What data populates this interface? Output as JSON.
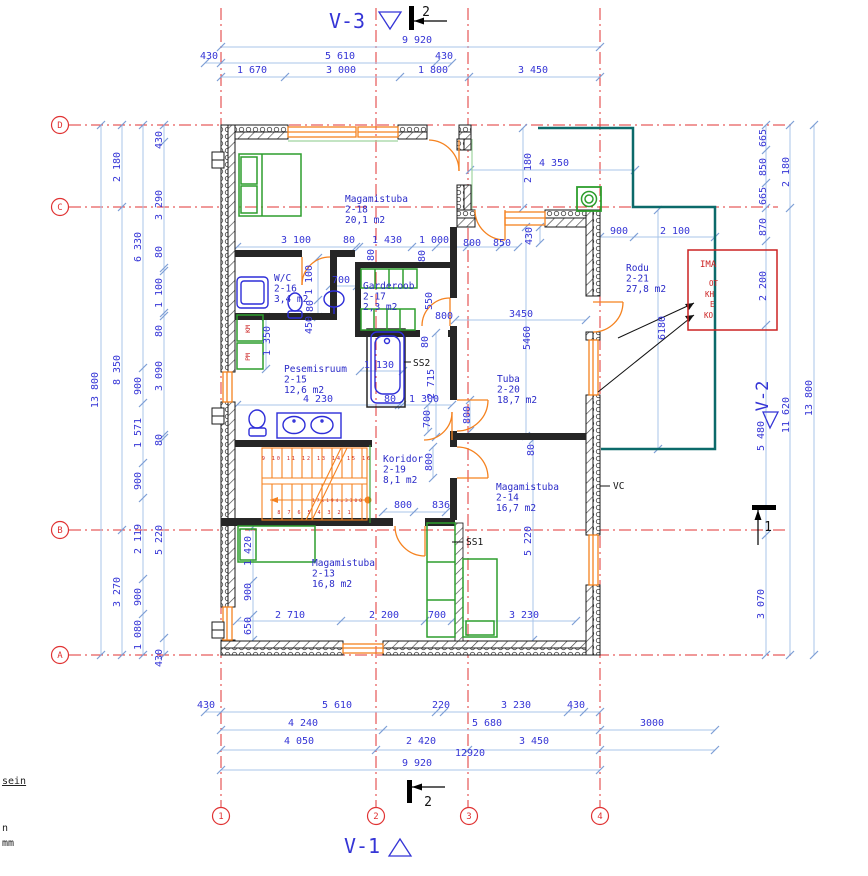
{
  "colors": {
    "dim_text": "#3535d6",
    "room_text": "#2a2ac8",
    "grid_red": "#e03333",
    "wall": "#1a1a1a",
    "window_orange": "#f5821f",
    "furniture_green": "#2d9e2d",
    "fixture_blue": "#2d2dd8",
    "terrace_teal": "#0c6a6a",
    "note_red": "#cc2222",
    "dim_line": "#a9c4ea"
  },
  "grid": {
    "rows": [
      {
        "label": "D",
        "y": 125
      },
      {
        "label": "C",
        "y": 207
      },
      {
        "label": "B",
        "y": 530
      },
      {
        "label": "A",
        "y": 655
      }
    ],
    "cols": [
      {
        "label": "1",
        "x": 221
      },
      {
        "label": "2",
        "x": 376
      },
      {
        "label": "3",
        "x": 469
      },
      {
        "label": "4",
        "x": 600
      }
    ]
  },
  "rooms": [
    {
      "name": "Magamistuba",
      "number": "2-18",
      "area": "20,1 m2",
      "x": 345,
      "y": 202
    },
    {
      "name": "W/C",
      "number": "2-16",
      "area": "3,4 m2",
      "x": 274,
      "y": 281
    },
    {
      "name": "Garderoob",
      "number": "2-17",
      "area": "2,3 m2",
      "x": 363,
      "y": 289
    },
    {
      "name": "Pesemisruum",
      "number": "2-15",
      "area": "12,6 m2",
      "x": 284,
      "y": 372
    },
    {
      "name": "Koridor",
      "number": "2-19",
      "area": "8,1 m2",
      "x": 383,
      "y": 462
    },
    {
      "name": "Tuba",
      "number": "2-20",
      "area": "18,7 m2",
      "x": 497,
      "y": 382
    },
    {
      "name": "Magamistuba",
      "number": "2-14",
      "area": "16,7 m2",
      "x": 496,
      "y": 490
    },
    {
      "name": "Magamistuba",
      "number": "2-13",
      "area": "16,8 m2",
      "x": 312,
      "y": 566
    },
    {
      "name": "Rodu",
      "number": "2-21",
      "area": "27,8 m2",
      "x": 626,
      "y": 271
    }
  ],
  "texts": {
    "view_labels": [
      {
        "t": "V-3",
        "x": 347,
        "y": 28,
        "s": 20
      },
      {
        "t": "V-1",
        "x": 362,
        "y": 853,
        "s": 20
      },
      {
        "t": "V-2",
        "x": 768,
        "y": 396,
        "s": 17,
        "r": -90
      }
    ],
    "section_labels": [
      {
        "t": "2",
        "x": 426,
        "y": 16
      },
      {
        "t": "2",
        "x": 428,
        "y": 806
      },
      {
        "t": "1",
        "x": 768,
        "y": 531
      }
    ],
    "dims": [
      {
        "t": "9 920",
        "x": 417,
        "y": 43
      },
      {
        "t": "430",
        "x": 209,
        "y": 59
      },
      {
        "t": "5 610",
        "x": 340,
        "y": 59
      },
      {
        "t": "430",
        "x": 444,
        "y": 59
      },
      {
        "t": "1 670",
        "x": 252,
        "y": 73
      },
      {
        "t": "3 000",
        "x": 341,
        "y": 73
      },
      {
        "t": "1 800",
        "x": 433,
        "y": 73
      },
      {
        "t": "3 450",
        "x": 533,
        "y": 73
      },
      {
        "t": "13 800",
        "x": 98,
        "y": 390,
        "r": -90
      },
      {
        "t": "2 180",
        "x": 120,
        "y": 167,
        "r": -90
      },
      {
        "t": "8 350",
        "x": 120,
        "y": 370,
        "r": -90
      },
      {
        "t": "3 270",
        "x": 120,
        "y": 592,
        "r": -90
      },
      {
        "t": "6 330",
        "x": 141,
        "y": 247,
        "r": -90
      },
      {
        "t": "900",
        "x": 141,
        "y": 386,
        "r": -90
      },
      {
        "t": "1 571",
        "x": 141,
        "y": 433,
        "r": -90
      },
      {
        "t": "900",
        "x": 141,
        "y": 481,
        "r": -90
      },
      {
        "t": "2 119",
        "x": 141,
        "y": 539,
        "r": -90
      },
      {
        "t": "900",
        "x": 141,
        "y": 597,
        "r": -90
      },
      {
        "t": "1 080",
        "x": 141,
        "y": 635,
        "r": -90
      },
      {
        "t": "430",
        "x": 162,
        "y": 140,
        "r": -90
      },
      {
        "t": "3 290",
        "x": 162,
        "y": 205,
        "r": -90
      },
      {
        "t": "80",
        "x": 162,
        "y": 252,
        "r": -90
      },
      {
        "t": "1 100",
        "x": 162,
        "y": 293,
        "r": -90
      },
      {
        "t": "80",
        "x": 162,
        "y": 331,
        "r": -90
      },
      {
        "t": "3 090",
        "x": 162,
        "y": 376,
        "r": -90
      },
      {
        "t": "80",
        "x": 162,
        "y": 440,
        "r": -90
      },
      {
        "t": "5 220",
        "x": 162,
        "y": 540,
        "r": -90
      },
      {
        "t": "430",
        "x": 162,
        "y": 658,
        "r": -90
      },
      {
        "t": "665",
        "x": 766,
        "y": 138,
        "r": -90
      },
      {
        "t": "850",
        "x": 766,
        "y": 167,
        "r": -90
      },
      {
        "t": "665",
        "x": 766,
        "y": 196,
        "r": -90
      },
      {
        "t": "870",
        "x": 766,
        "y": 227,
        "r": -90
      },
      {
        "t": "2 200",
        "x": 766,
        "y": 286,
        "r": -90
      },
      {
        "t": "5 480",
        "x": 764,
        "y": 436,
        "r": -90
      },
      {
        "t": "3 070",
        "x": 764,
        "y": 604,
        "r": -90
      },
      {
        "t": "2 180",
        "x": 789,
        "y": 172,
        "r": -90
      },
      {
        "t": "11 620",
        "x": 789,
        "y": 415,
        "r": -90
      },
      {
        "t": "13 800",
        "x": 812,
        "y": 398,
        "r": -90
      },
      {
        "t": "430",
        "x": 206,
        "y": 708
      },
      {
        "t": "5 610",
        "x": 337,
        "y": 708
      },
      {
        "t": "220",
        "x": 441,
        "y": 708
      },
      {
        "t": "3 230",
        "x": 516,
        "y": 708
      },
      {
        "t": "430",
        "x": 576,
        "y": 708
      },
      {
        "t": "4 240",
        "x": 303,
        "y": 726
      },
      {
        "t": "5 680",
        "x": 487,
        "y": 726
      },
      {
        "t": "3000",
        "x": 652,
        "y": 726
      },
      {
        "t": "4 050",
        "x": 299,
        "y": 744
      },
      {
        "t": "2 420",
        "x": 421,
        "y": 744
      },
      {
        "t": "3 450",
        "x": 534,
        "y": 744
      },
      {
        "t": "12920",
        "x": 470,
        "y": 756
      },
      {
        "t": "9 920",
        "x": 417,
        "y": 766
      },
      {
        "t": "3 100",
        "x": 296,
        "y": 243
      },
      {
        "t": "80",
        "x": 349,
        "y": 243
      },
      {
        "t": "1 430",
        "x": 387,
        "y": 243
      },
      {
        "t": "1 000",
        "x": 434,
        "y": 243
      },
      {
        "t": "800",
        "x": 472,
        "y": 246
      },
      {
        "t": "850",
        "x": 502,
        "y": 246
      },
      {
        "t": "4 350",
        "x": 554,
        "y": 166
      },
      {
        "t": "2 180",
        "x": 531,
        "y": 168,
        "r": -90
      },
      {
        "t": "430",
        "x": 532,
        "y": 236,
        "r": -90
      },
      {
        "t": "900",
        "x": 619,
        "y": 234
      },
      {
        "t": "2 100",
        "x": 675,
        "y": 234
      },
      {
        "t": "1 100",
        "x": 312,
        "y": 280,
        "r": -90
      },
      {
        "t": "700",
        "x": 341,
        "y": 283
      },
      {
        "t": "80",
        "x": 313,
        "y": 306,
        "r": -90
      },
      {
        "t": "450",
        "x": 312,
        "y": 325,
        "r": -90
      },
      {
        "t": "1 350",
        "x": 270,
        "y": 341,
        "r": -90
      },
      {
        "t": "80",
        "x": 374,
        "y": 255,
        "r": -90
      },
      {
        "t": "80",
        "x": 425,
        "y": 256,
        "r": -90
      },
      {
        "t": "550",
        "x": 432,
        "y": 301,
        "r": -90
      },
      {
        "t": "800",
        "x": 444,
        "y": 319
      },
      {
        "t": "1 130",
        "x": 379,
        "y": 368
      },
      {
        "t": "2 715",
        "x": 434,
        "y": 384,
        "r": -90
      },
      {
        "t": "80",
        "x": 428,
        "y": 342,
        "r": -90
      },
      {
        "t": "4 230",
        "x": 318,
        "y": 402
      },
      {
        "t": "80",
        "x": 390,
        "y": 402
      },
      {
        "t": "1 300",
        "x": 424,
        "y": 402
      },
      {
        "t": "700",
        "x": 430,
        "y": 419,
        "r": -90
      },
      {
        "t": "3450",
        "x": 521,
        "y": 317
      },
      {
        "t": "5460",
        "x": 530,
        "y": 338,
        "r": -90
      },
      {
        "t": "6180",
        "x": 665,
        "y": 328,
        "r": -90
      },
      {
        "t": "800",
        "x": 470,
        "y": 415,
        "r": -90
      },
      {
        "t": "80",
        "x": 534,
        "y": 450,
        "r": -90
      },
      {
        "t": "800",
        "x": 432,
        "y": 462,
        "r": -90
      },
      {
        "t": "800",
        "x": 403,
        "y": 508
      },
      {
        "t": "836",
        "x": 441,
        "y": 508
      },
      {
        "t": "5 220",
        "x": 531,
        "y": 541,
        "r": -90
      },
      {
        "t": "1 420",
        "x": 251,
        "y": 551,
        "r": -90
      },
      {
        "t": "900",
        "x": 251,
        "y": 592,
        "r": -90
      },
      {
        "t": "650",
        "x": 251,
        "y": 626,
        "r": -90
      },
      {
        "t": "2 710",
        "x": 290,
        "y": 618
      },
      {
        "t": "2 200",
        "x": 384,
        "y": 618
      },
      {
        "t": "700",
        "x": 437,
        "y": 618
      },
      {
        "t": "3 230",
        "x": 524,
        "y": 618
      }
    ],
    "annotations": [
      {
        "t": "SS2",
        "x": 413,
        "y": 366
      },
      {
        "t": "SS1",
        "x": 466,
        "y": 545
      },
      {
        "t": "VC",
        "x": 613,
        "y": 489
      }
    ],
    "km_pm": [
      {
        "t": "KM",
        "x": 250,
        "y": 329,
        "r": -90
      },
      {
        "t": "PM",
        "x": 250,
        "y": 357,
        "r": -90
      }
    ],
    "red_note": [
      {
        "t": "IMA",
        "x": 700,
        "y": 267,
        "s": 9
      },
      {
        "t": "OT",
        "x": 709,
        "y": 286
      },
      {
        "t": "KH",
        "x": 705,
        "y": 297
      },
      {
        "t": "E",
        "x": 710,
        "y": 307
      },
      {
        "t": "KO",
        "x": 704,
        "y": 318
      }
    ],
    "stair_texts": [
      {
        "t": "9 10 11 12 13 14 15 16",
        "x": 317,
        "y": 460,
        "s": 5
      },
      {
        "t": "8 7 6 5 4 3 2 1",
        "x": 315,
        "y": 514,
        "s": 5
      },
      {
        "t": "17x194=3300",
        "x": 338,
        "y": 502,
        "s": 4.5
      }
    ],
    "legend_fragments": [
      {
        "t": "sein",
        "x": 2,
        "y": 784,
        "u": true
      },
      {
        "t": "n",
        "x": 2,
        "y": 831
      },
      {
        "t": "mm",
        "x": 2,
        "y": 846
      }
    ]
  },
  "dim_chains": [
    {
      "o": "h",
      "pos": 47,
      "from": 221,
      "to": 600,
      "ticks": [
        221,
        600
      ]
    },
    {
      "o": "h",
      "pos": 63,
      "from": 205,
      "to": 452,
      "ticks": [
        205,
        221,
        436,
        452
      ]
    },
    {
      "o": "h",
      "pos": 77,
      "from": 221,
      "to": 600,
      "ticks": [
        221,
        285,
        400,
        469,
        600
      ]
    },
    {
      "o": "h",
      "pos": 712,
      "from": 205,
      "to": 600,
      "ticks": [
        205,
        221,
        436,
        444,
        568,
        584,
        600
      ]
    },
    {
      "o": "h",
      "pos": 730,
      "from": 221,
      "to": 715,
      "ticks": [
        221,
        383,
        600,
        715
      ]
    },
    {
      "o": "h",
      "pos": 750,
      "from": 221,
      "to": 715,
      "ticks": [
        221,
        376,
        468,
        600,
        715
      ]
    },
    {
      "o": "h",
      "pos": 770,
      "from": 221,
      "to": 600,
      "ticks": [
        221,
        600
      ]
    },
    {
      "o": "h",
      "pos": 247,
      "from": 237,
      "to": 518,
      "ticks": [
        237,
        356,
        359,
        412,
        436,
        467,
        500,
        518
      ]
    },
    {
      "o": "h",
      "pos": 170,
      "from": 470,
      "to": 635,
      "ticks": [
        470,
        635
      ]
    },
    {
      "o": "h",
      "pos": 237,
      "from": 600,
      "to": 715,
      "ticks": [
        600,
        634,
        715
      ]
    },
    {
      "o": "h",
      "pos": 286,
      "from": 330,
      "to": 357,
      "ticks": [
        330,
        357
      ]
    },
    {
      "o": "h",
      "pos": 371,
      "from": 360,
      "to": 403,
      "ticks": [
        360,
        403
      ]
    },
    {
      "o": "h",
      "pos": 405,
      "from": 237,
      "to": 452,
      "ticks": [
        237,
        399,
        402,
        452
      ]
    },
    {
      "o": "h",
      "pos": 512,
      "from": 383,
      "to": 446,
      "ticks": [
        383,
        414,
        446
      ]
    },
    {
      "o": "h",
      "pos": 621,
      "from": 237,
      "to": 576,
      "ticks": [
        237,
        341,
        425,
        452,
        576
      ]
    },
    {
      "o": "h",
      "pos": 320,
      "from": 455,
      "to": 586,
      "ticks": [
        455,
        586
      ]
    },
    {
      "o": "v",
      "pos": 101,
      "from": 125,
      "to": 655,
      "ticks": [
        125,
        655
      ]
    },
    {
      "o": "v",
      "pos": 122,
      "from": 125,
      "to": 655,
      "ticks": [
        125,
        207,
        530,
        655
      ]
    },
    {
      "o": "v",
      "pos": 143,
      "from": 125,
      "to": 655,
      "ticks": [
        125,
        368,
        403,
        463,
        498,
        579,
        614,
        655
      ]
    },
    {
      "o": "v",
      "pos": 164,
      "from": 125,
      "to": 655,
      "ticks": [
        125,
        142,
        268,
        271,
        313,
        316,
        435,
        438,
        638,
        655
      ]
    },
    {
      "o": "v",
      "pos": 766,
      "from": 125,
      "to": 655,
      "ticks": [
        125,
        150,
        183,
        208,
        241,
        325,
        535,
        655
      ]
    },
    {
      "o": "v",
      "pos": 790,
      "from": 125,
      "to": 655,
      "ticks": [
        125,
        208,
        655
      ]
    },
    {
      "o": "v",
      "pos": 814,
      "from": 125,
      "to": 655,
      "ticks": [
        125,
        655
      ]
    },
    {
      "o": "v",
      "pos": 523,
      "from": 128,
      "to": 208,
      "ticks": [
        128,
        208
      ]
    },
    {
      "o": "v",
      "pos": 540,
      "from": 227,
      "to": 243,
      "ticks": [
        227,
        243
      ]
    },
    {
      "o": "v",
      "pos": 253,
      "from": 527,
      "to": 640,
      "ticks": [
        527,
        581,
        615,
        640
      ]
    },
    {
      "o": "v",
      "pos": 533,
      "from": 440,
      "to": 640,
      "ticks": [
        440,
        640
      ]
    },
    {
      "o": "v",
      "pos": 526,
      "from": 227,
      "to": 436,
      "ticks": [
        227,
        436
      ]
    },
    {
      "o": "v",
      "pos": 436,
      "from": 333,
      "to": 437,
      "ticks": [
        333,
        437
      ]
    },
    {
      "o": "v",
      "pos": 658,
      "from": 210,
      "to": 449,
      "ticks": [
        210,
        449
      ]
    },
    {
      "o": "v",
      "pos": 318,
      "from": 258,
      "to": 317,
      "ticks": [
        258,
        300,
        317
      ]
    },
    {
      "o": "v",
      "pos": 470,
      "from": 400,
      "to": 431,
      "ticks": [
        400,
        431
      ]
    },
    {
      "o": "v",
      "pos": 433,
      "from": 447,
      "to": 478,
      "ticks": [
        447,
        478
      ]
    },
    {
      "o": "v",
      "pos": 428,
      "from": 405,
      "to": 432,
      "ticks": [
        405,
        432
      ]
    },
    {
      "o": "v",
      "pos": 266,
      "from": 317,
      "to": 369,
      "ticks": [
        317,
        369
      ]
    }
  ]
}
